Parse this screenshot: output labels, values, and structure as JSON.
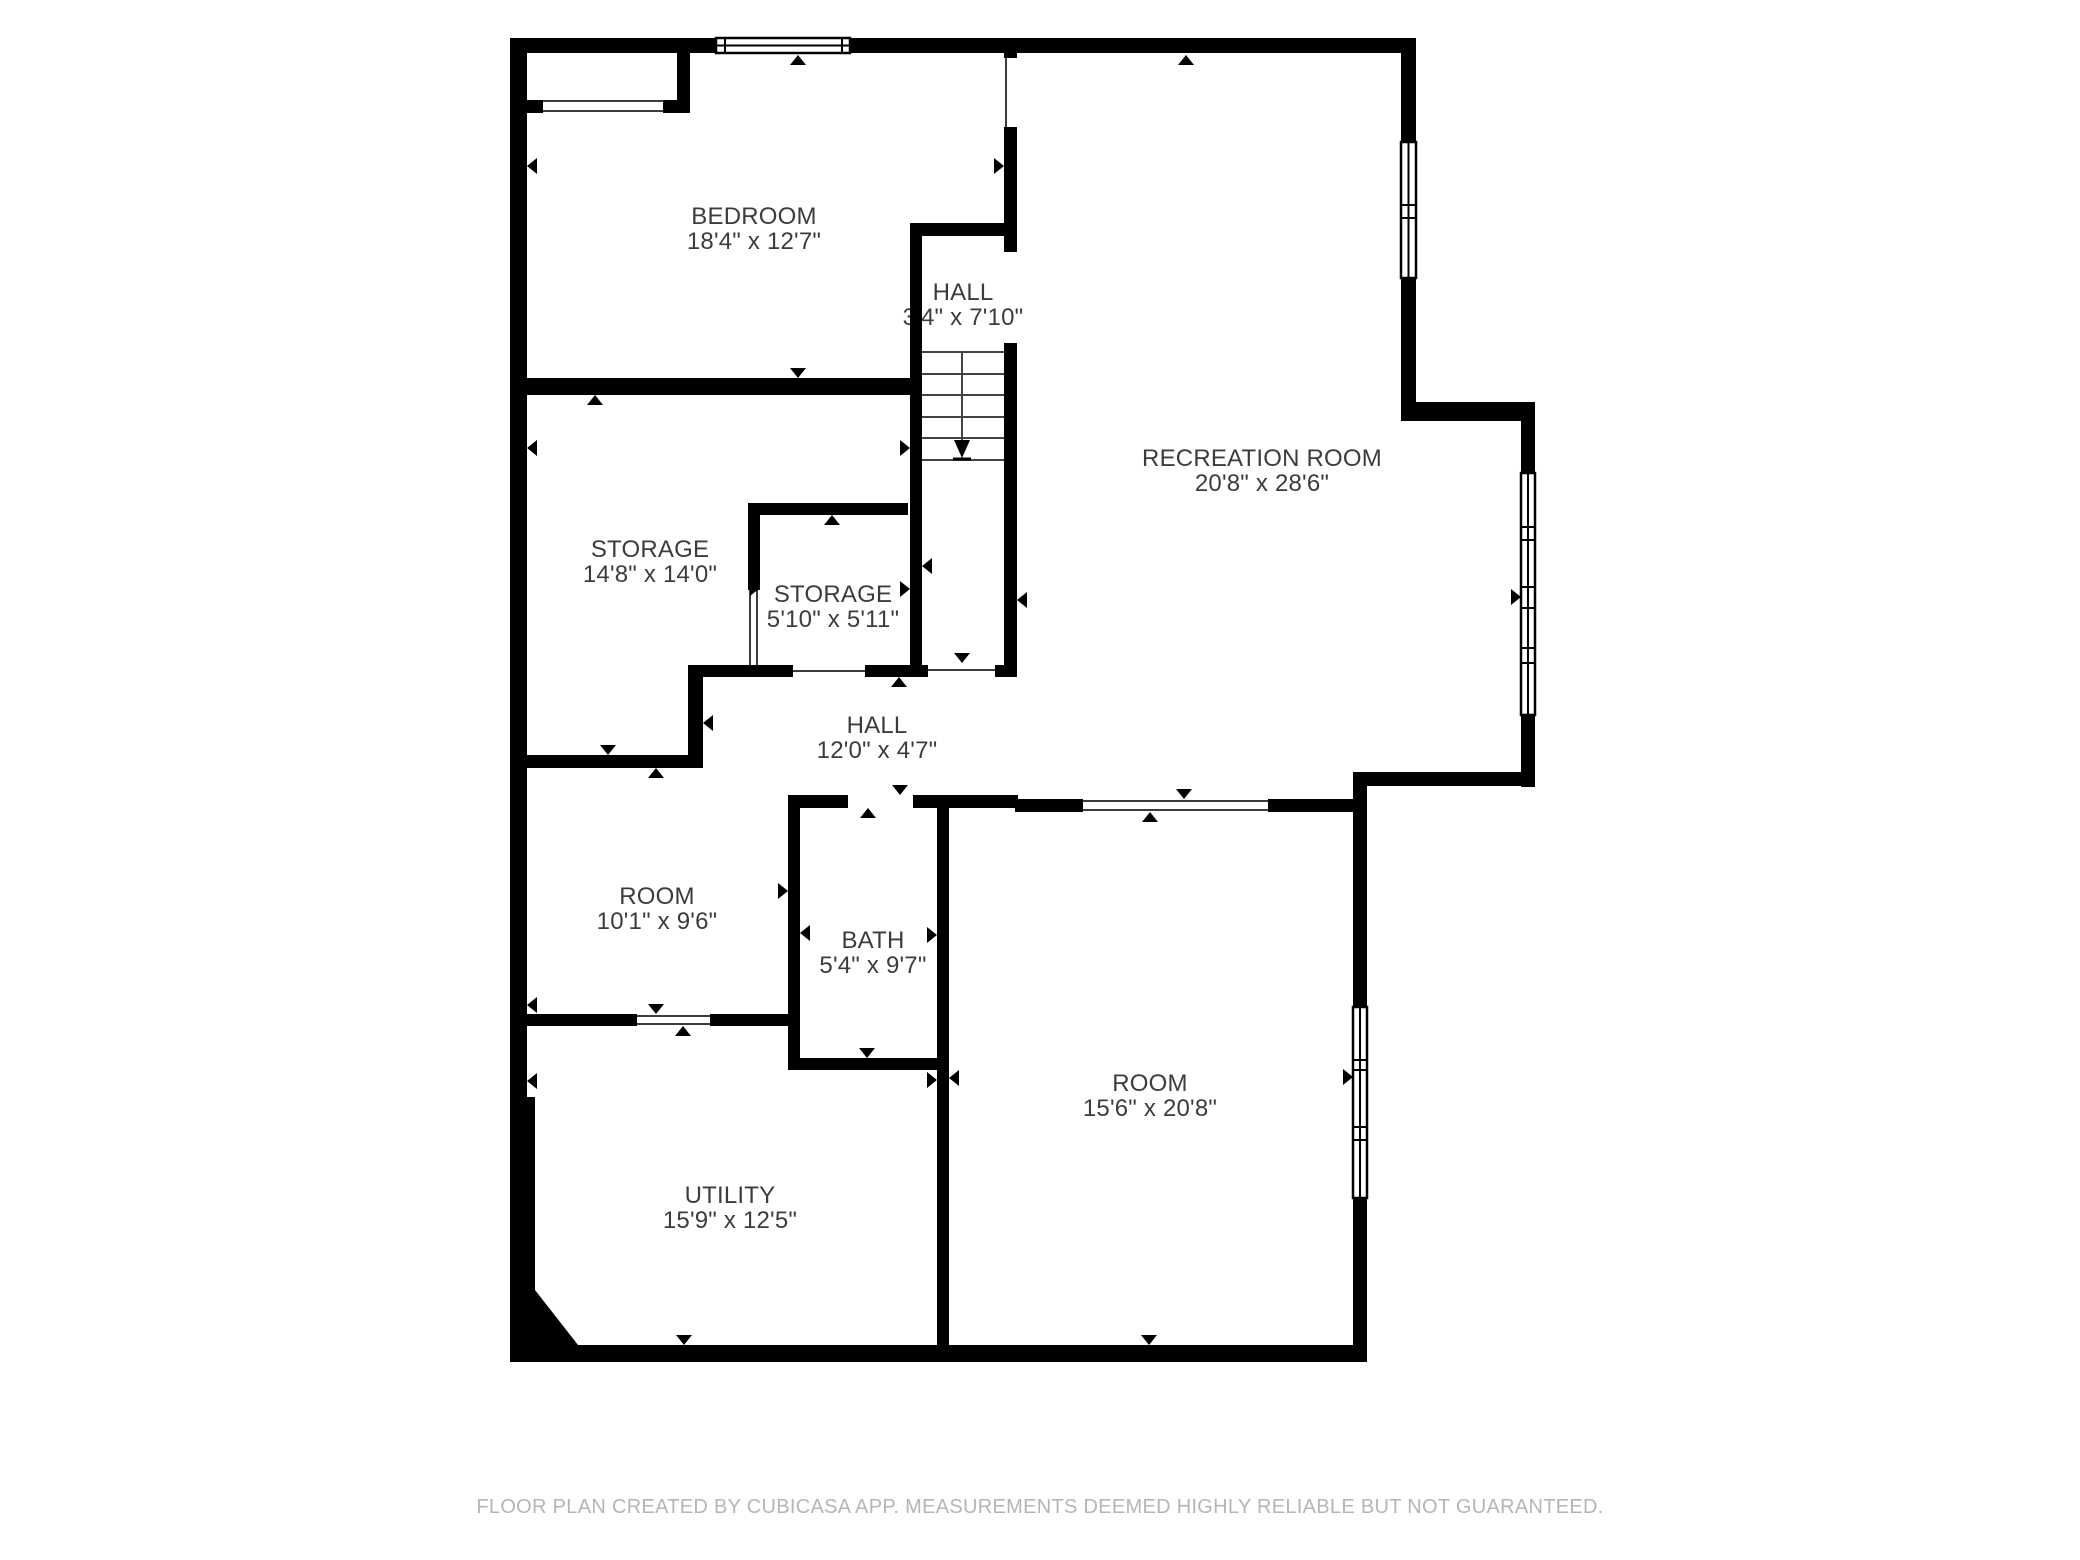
{
  "floorplan": {
    "rooms": [
      {
        "name": "BEDROOM",
        "dims": "18'4\" x 12'7\""
      },
      {
        "name": "HALL",
        "dims": "3'4\" x 7'10\""
      },
      {
        "name": "RECREATION ROOM",
        "dims": "20'8\" x 28'6\""
      },
      {
        "name": "STORAGE",
        "dims": "14'8\" x 14'0\""
      },
      {
        "name": "STORAGE",
        "dims": "5'10\" x 5'11\""
      },
      {
        "name": "HALL",
        "dims": "12'0\" x 4'7\""
      },
      {
        "name": "ROOM",
        "dims": "10'1\" x 9'6\""
      },
      {
        "name": "BATH",
        "dims": "5'4\" x 9'7\""
      },
      {
        "name": "ROOM",
        "dims": "15'6\" x 20'8\""
      },
      {
        "name": "UTILITY",
        "dims": "15'9\" x 12'5\""
      }
    ]
  },
  "footer": {
    "text": "FLOOR PLAN CREATED BY CUBICASA APP. MEASUREMENTS DEEMED HIGHLY RELIABLE BUT NOT GUARANTEED."
  },
  "colors": {
    "wall": "#000000",
    "label_text": "#3c3c3c",
    "footer_text": "#b5b5b5",
    "background": "#ffffff"
  }
}
